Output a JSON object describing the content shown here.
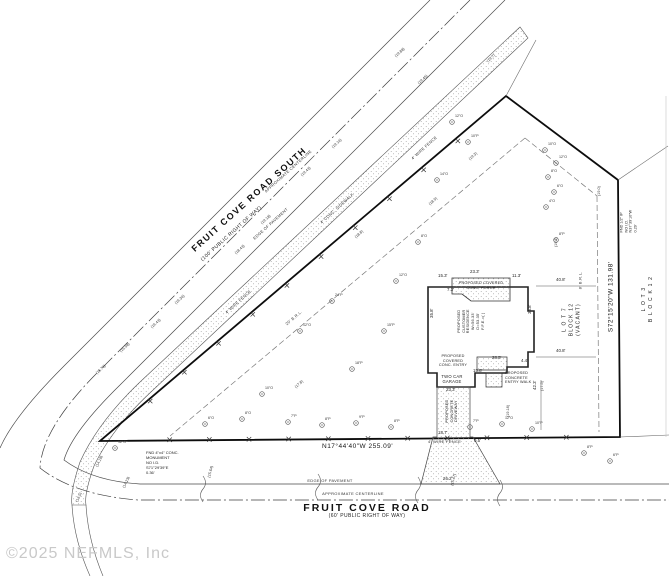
{
  "drawing": {
    "copyright": "©2025 NEFMLS, Inc",
    "colors": {
      "ink": "#2b2b2b",
      "boundary": "#111111",
      "dashed": "#7a7a7a",
      "stipple": "#8f8f8f",
      "watermark": "#c9c9c9"
    },
    "roads": {
      "south": {
        "name": "FRUIT COVE ROAD SOUTH",
        "right_of_way": "(100' PUBLIC RIGHT OF WAY)",
        "centerline": "APPROXIMATE CENTERLINE",
        "edge": "EDGE OF PAVEMENT",
        "sidewalk": "4' CONC. SIDEWALK"
      },
      "main": {
        "name": "FRUIT COVE ROAD",
        "right_of_way": "(60' PUBLIC RIGHT OF WAY)",
        "centerline": "APPROXIMATE CENTERLINE",
        "edge": "EDGE OF PAVEMENT"
      }
    },
    "boundary": {
      "south_bearing": "N17°44'40\"W   255.09'",
      "east_bearing": "S72°15'20\"W   131.98'",
      "fence": "4' WIRE FENCE"
    },
    "lots": {
      "lot7": {
        "l1": "L O T   7",
        "l2": "BLOCK 12",
        "l3": "(VACANT)"
      },
      "lot3": {
        "l1": "L O T   3",
        "l2": "B L O C K   1 2"
      }
    },
    "brl": {
      "east": "8' B.R.L.",
      "northwest": "20' B.R.L."
    },
    "house": {
      "residence": {
        "l1": "PROPOSED",
        "l2": "CUSTOMER",
        "l3": "RESIDENCE",
        "l4": "W=56.33'",
        "l5": "D=53.35'",
        "l6": "F.F.E.=(      )"
      },
      "porch": {
        "l1": "PROPOSED COVERED",
        "l2": "CONC. PORCH"
      },
      "entry": {
        "l1": "PROPOSED",
        "l2": "COVERED",
        "l3": "CONC. ENTRY"
      },
      "garage": {
        "l1": "TWO CAR",
        "l2": "GARAGE"
      },
      "driveway": {
        "l1": "PROPOSED",
        "l2": "CONCRETE",
        "l3": "DRIVEWAY"
      },
      "walk": {
        "l1": "PROPOSED",
        "l2": "CONCRETE",
        "l3": "ENTRY WALK"
      }
    },
    "monuments": {
      "southwest": {
        "l1": "FND 4\"x4\" CONC.",
        "l2": "MONUMENT",
        "l3": "NO I.D.",
        "l4": "S71°29'39\"E",
        "l5": "0.36'"
      },
      "northeast": {
        "l1": "FND 1/2\" IP",
        "l2": "NO I.D.",
        "l3": "N37°39'10\"W",
        "l4": "0.29'"
      }
    },
    "dimensions": [
      {
        "t": "15.3'",
        "x": 438,
        "y": 273
      },
      {
        "t": "23.3'",
        "x": 470,
        "y": 269
      },
      {
        "t": "11.3'",
        "x": 512,
        "y": 273
      },
      {
        "t": "7.3'",
        "x": 447,
        "y": 287
      },
      {
        "t": "35.8'",
        "x": 429,
        "y": 318,
        "r": -90
      },
      {
        "t": "35.8'",
        "x": 527,
        "y": 314,
        "r": -90
      },
      {
        "t": "28.5'",
        "x": 492,
        "y": 355
      },
      {
        "t": "4.4'",
        "x": 521,
        "y": 358
      },
      {
        "t": "15.8'",
        "x": 473,
        "y": 368
      },
      {
        "t": "23.3'",
        "x": 446,
        "y": 387
      },
      {
        "t": "18.7'",
        "x": 438,
        "y": 430
      },
      {
        "t": "0.5'",
        "x": 474,
        "y": 438
      },
      {
        "t": "26.2'",
        "x": 443,
        "y": 476
      },
      {
        "t": "42.3'",
        "x": 532,
        "y": 390,
        "r": -90
      },
      {
        "t": "40.8'",
        "x": 556,
        "y": 277
      },
      {
        "t": "40.8'",
        "x": 556,
        "y": 348
      }
    ],
    "spot_elevations": [
      {
        "t": "(19.88)",
        "x": 394,
        "y": 55,
        "r": -42
      },
      {
        "t": "(19.7)",
        "x": 486,
        "y": 60,
        "r": -42
      },
      {
        "t": "(19.45)",
        "x": 417,
        "y": 82,
        "r": -42
      },
      {
        "t": "(19.3)",
        "x": 468,
        "y": 158,
        "r": -42
      },
      {
        "t": "(19.16)",
        "x": 331,
        "y": 146,
        "r": -42
      },
      {
        "t": "(19.43)",
        "x": 300,
        "y": 174,
        "r": -42
      },
      {
        "t": "(18.9)",
        "x": 428,
        "y": 203,
        "r": -42
      },
      {
        "t": "(18.8)",
        "x": 354,
        "y": 236,
        "r": -42
      },
      {
        "t": "(19.18)",
        "x": 260,
        "y": 222,
        "r": -42
      },
      {
        "t": "(18.43)",
        "x": 234,
        "y": 252,
        "r": -42
      },
      {
        "t": "(16.43)",
        "x": 150,
        "y": 326,
        "r": -42
      },
      {
        "t": "(16.36)",
        "x": 174,
        "y": 302,
        "r": -42
      },
      {
        "t": "(15.98)",
        "x": 119,
        "y": 350,
        "r": -42
      },
      {
        "t": "(15.76)",
        "x": 95,
        "y": 372,
        "r": -42
      },
      {
        "t": "(17.8)",
        "x": 294,
        "y": 386,
        "r": -42
      },
      {
        "t": "(14.18)",
        "x": 95,
        "y": 466,
        "r": -65
      },
      {
        "t": "(14.23)",
        "x": 122,
        "y": 487,
        "r": -65
      },
      {
        "t": "(13.5)",
        "x": 75,
        "y": 501,
        "r": -65
      },
      {
        "t": "(15.64)",
        "x": 207,
        "y": 477,
        "r": -75
      },
      {
        "t": "(15.47)",
        "x": 450,
        "y": 485,
        "r": -75
      },
      {
        "t": "(19.2)",
        "x": 554,
        "y": 247,
        "r": -90
      },
      {
        "t": "(19.0)",
        "x": 597,
        "y": 196,
        "r": -90
      },
      {
        "t": "(17.5)",
        "x": 540,
        "y": 391,
        "r": -90
      },
      {
        "t": "(19.18)",
        "x": 506,
        "y": 417,
        "r": -90
      }
    ],
    "trees": [
      {
        "x": 205,
        "y": 424,
        "t": "6\"O"
      },
      {
        "x": 242,
        "y": 419,
        "t": "8\"O"
      },
      {
        "x": 288,
        "y": 422,
        "t": "7\"P"
      },
      {
        "x": 322,
        "y": 425,
        "t": "8\"P"
      },
      {
        "x": 356,
        "y": 423,
        "t": "9\"P"
      },
      {
        "x": 391,
        "y": 427,
        "t": "8\"P"
      },
      {
        "x": 470,
        "y": 427,
        "t": "7\"P"
      },
      {
        "x": 502,
        "y": 424,
        "t": "12\"O"
      },
      {
        "x": 532,
        "y": 429,
        "t": "10\"P"
      },
      {
        "x": 584,
        "y": 453,
        "t": "8\"P"
      },
      {
        "x": 610,
        "y": 461,
        "t": "6\"P"
      },
      {
        "x": 300,
        "y": 331,
        "t": "12\"O"
      },
      {
        "x": 332,
        "y": 301,
        "t": "24\"P"
      },
      {
        "x": 384,
        "y": 331,
        "t": "15\"P"
      },
      {
        "x": 396,
        "y": 281,
        "t": "12\"O"
      },
      {
        "x": 352,
        "y": 369,
        "t": "18\"P"
      },
      {
        "x": 262,
        "y": 394,
        "t": "10\"O"
      },
      {
        "x": 418,
        "y": 242,
        "t": "8\"O"
      },
      {
        "x": 545,
        "y": 150,
        "t": "10\"O"
      },
      {
        "x": 556,
        "y": 163,
        "t": "12\"O"
      },
      {
        "x": 548,
        "y": 177,
        "t": "8\"O"
      },
      {
        "x": 554,
        "y": 192,
        "t": "6\"O"
      },
      {
        "x": 546,
        "y": 207,
        "t": "4\"O"
      },
      {
        "x": 556,
        "y": 240,
        "t": "8\"P"
      },
      {
        "x": 452,
        "y": 122,
        "t": "12\"O"
      },
      {
        "x": 468,
        "y": 142,
        "t": "10\"P"
      },
      {
        "x": 437,
        "y": 180,
        "t": "14\"O"
      },
      {
        "x": 115,
        "y": 448,
        "t": "12\"O"
      }
    ]
  }
}
